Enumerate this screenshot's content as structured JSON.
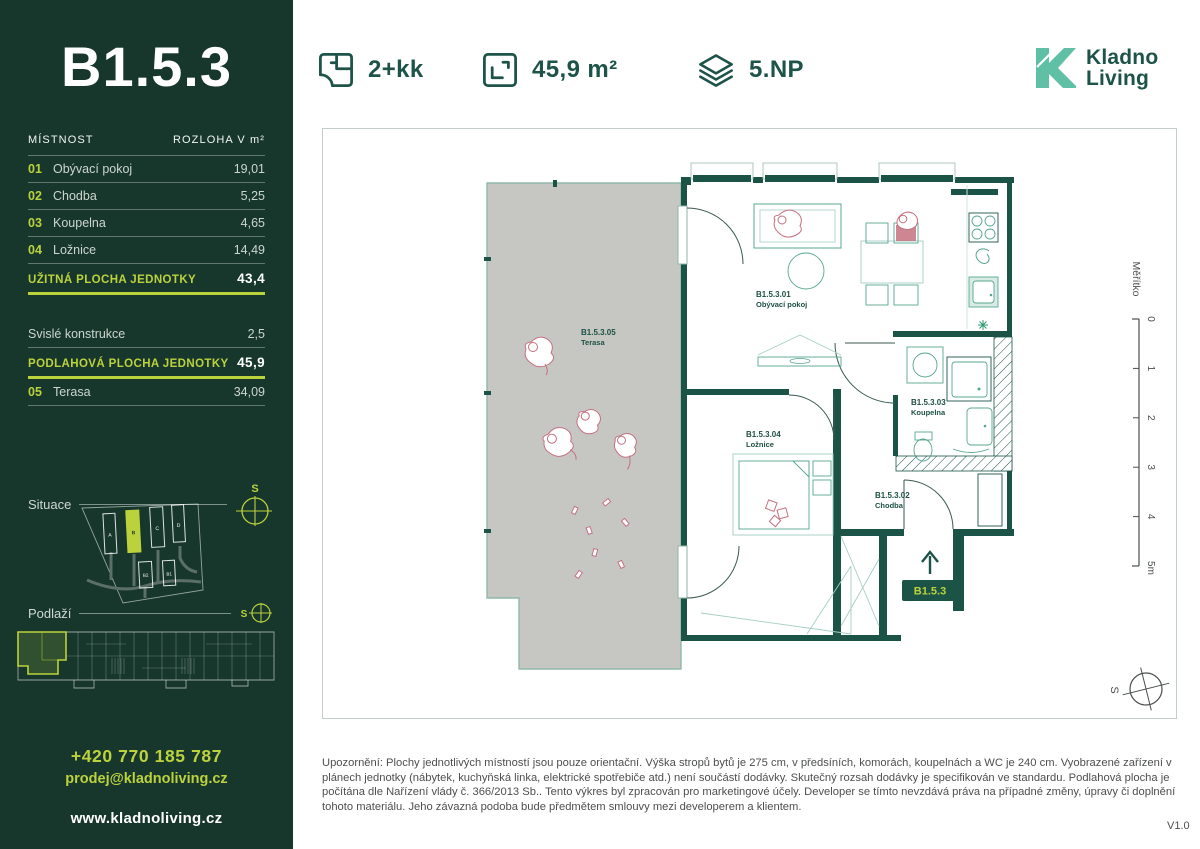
{
  "header": {
    "layout_label": "2+kk",
    "area_label": "45,9 m²",
    "floor_label": "5.NP",
    "logo": {
      "line1": "Kladno",
      "line2": "Living"
    }
  },
  "sidebar": {
    "unit_title": "B1.5.3",
    "table": {
      "col_room": "MÍSTNOST",
      "col_area": "ROZLOHA V m²",
      "rows": [
        {
          "num": "01",
          "name": "Obývací pokoj",
          "area": "19,01"
        },
        {
          "num": "02",
          "name": "Chodba",
          "area": "5,25"
        },
        {
          "num": "03",
          "name": "Koupelna",
          "area": "4,65"
        },
        {
          "num": "04",
          "name": "Ložnice",
          "area": "14,49"
        }
      ],
      "summary_usable": {
        "label": "UŽITNÁ PLOCHA JEDNOTKY",
        "value": "43,4"
      },
      "row_vertical": {
        "label": "Svislé konstrukce",
        "value": "2,5"
      },
      "summary_floor": {
        "label": "PODLAHOVÁ PLOCHA JEDNOTKY",
        "value": "45,9"
      },
      "row_terrace": {
        "num": "05",
        "name": "Terasa",
        "area": "34,09"
      }
    },
    "situace_label": "Situace",
    "podlazi_label": "Podlaží",
    "compass_letter": "S",
    "site_buildings": [
      "A",
      "B",
      "C",
      "D",
      "B2",
      "B1"
    ],
    "contact": {
      "phone": "+420 770 185 787",
      "email": "prodej@kladnoliving.cz",
      "web": "www.kladnoliving.cz"
    }
  },
  "plan": {
    "rooms": [
      {
        "id": "B1.5.3.01",
        "name": "Obývací pokoj"
      },
      {
        "id": "B1.5.3.02",
        "name": "Chodba"
      },
      {
        "id": "B1.5.3.03",
        "name": "Koupelna"
      },
      {
        "id": "B1.5.3.04",
        "name": "Ložnice"
      },
      {
        "id": "B1.5.3.05",
        "name": "Terasa"
      }
    ],
    "entrance_badge": "B1.5.3",
    "scale": {
      "label": "Měřítko",
      "ticks": [
        "0",
        "1",
        "2",
        "3",
        "4",
        "5m"
      ]
    },
    "compass_letter": "S"
  },
  "footer": {
    "disclaimer": "Upozornění: Plochy jednotlivých místností jsou pouze orientační. Výška stropů bytů je 275 cm, v předsíních, komorách, koupelnách a WC je 240 cm. Vyobrazené zařízení v plánech jednotky (nábytek, kuchyňská linka, elektrické spotřebiče atd.) není součástí dodávky. Skutečný rozsah dodávky je specifikován ve standardu. Podlahová plocha je počítána dle Nařízení vlády č. 366/2013 Sb.. Tento výkres byl zpracován pro marketingové účely. Developer se tímto nevzdává práva na případné změny, úpravy či doplnění tohoto materiálu. Jeho závazná podoba bude předmětem smlouvy mezi developerem a klientem.",
    "version": "V1.0"
  },
  "colors": {
    "sidebar_bg": "#17372D",
    "accent_lime": "#BCD23C",
    "brand_green": "#1D5348",
    "wall_green": "#1B5347",
    "logo_mint": "#5FC0A6",
    "terrace_gray": "#C6C7C3",
    "furniture_teal": "#57A78F",
    "people_pink": "#C5717F"
  }
}
